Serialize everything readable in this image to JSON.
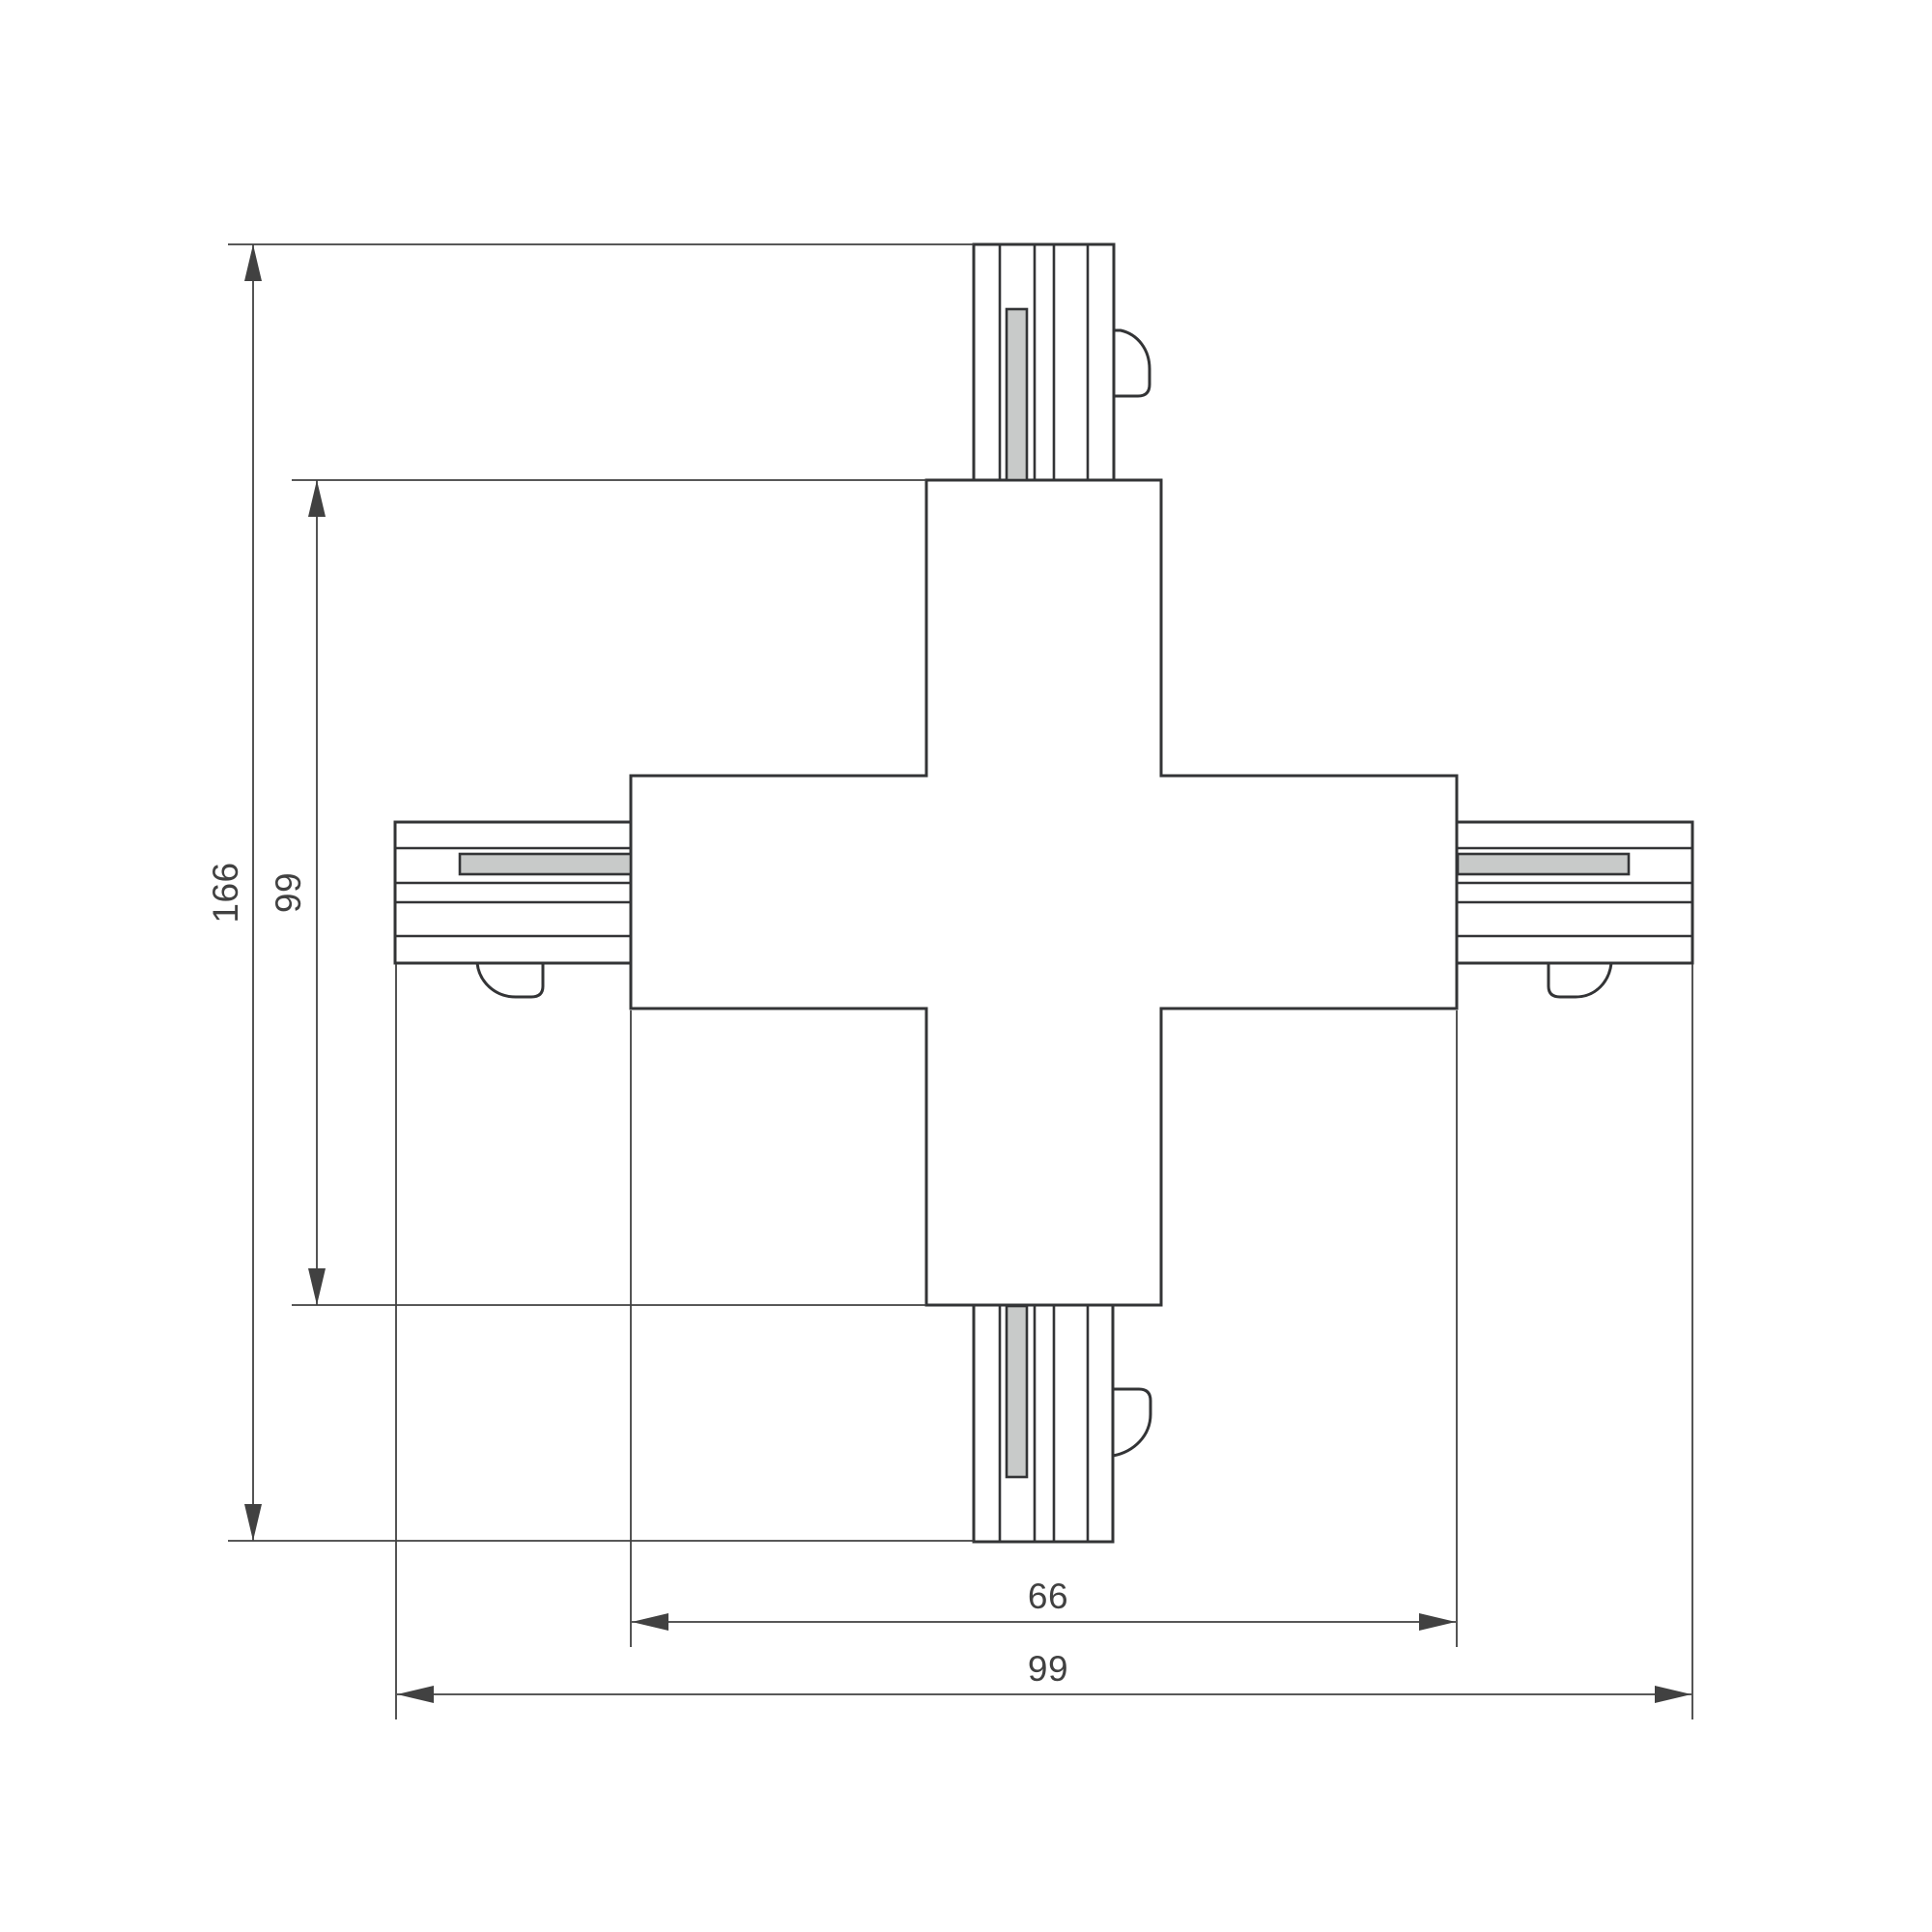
{
  "drawing": {
    "type": "technical-dimension-drawing",
    "subject": "X-shaped track connector, top view with four track stubs",
    "dimensions": {
      "overall_height": "166",
      "body_height": "99",
      "body_width": "66",
      "overall_width": "99"
    }
  },
  "colors": {
    "background": "#ffffff",
    "line": "#333436",
    "dimension": "#414141",
    "strip_fill": "#c8cac9"
  }
}
